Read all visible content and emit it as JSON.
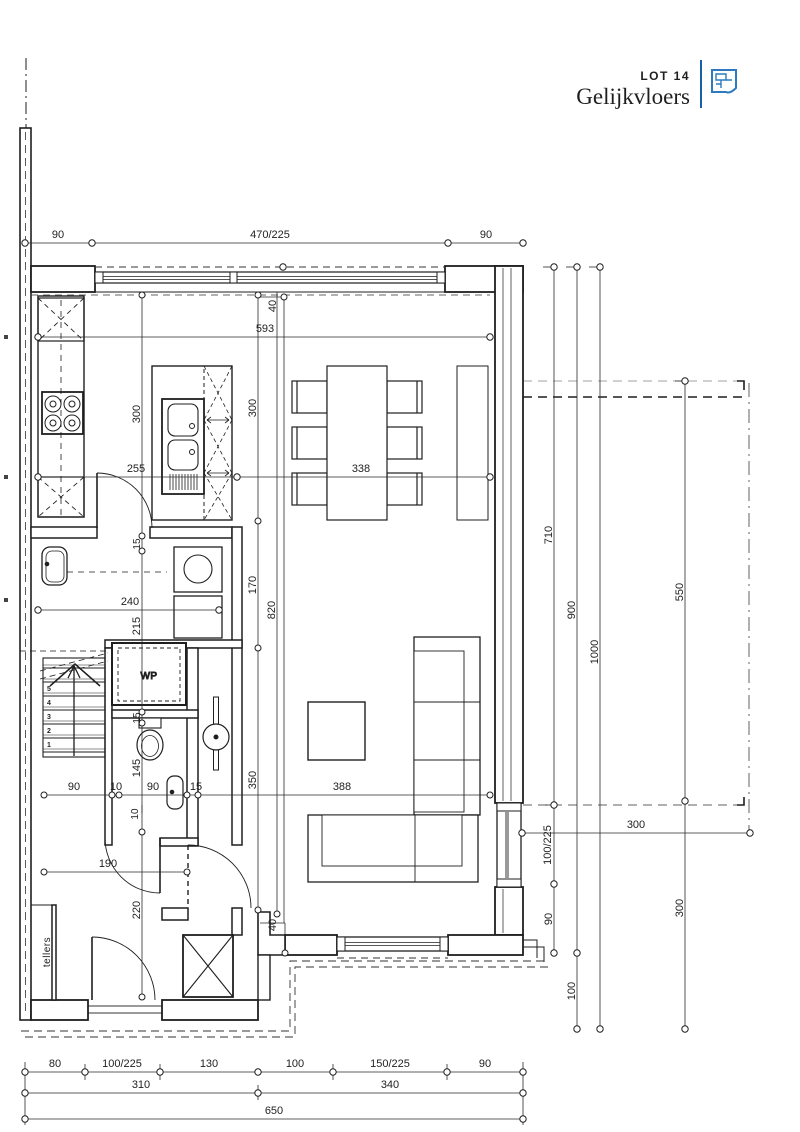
{
  "title_block": {
    "lot_label": "LOT 14",
    "floor_label": "Gelijkvloers",
    "accent_color": "#1b5fa8",
    "lot_color": "#4d8cc2",
    "icon": "floorplan-icon"
  },
  "rooms": {
    "wp_label": "WP",
    "tellers_label": "tellers"
  },
  "stairs": {
    "treads": [
      "1",
      "2",
      "3",
      "4",
      "5"
    ]
  },
  "dims": {
    "top": {
      "a": "90",
      "b": "470/225",
      "c": "90"
    },
    "plan": {
      "d593": "593",
      "d40_top": "40",
      "d300_left": "300",
      "d300_right": "300",
      "d255": "255",
      "d338": "338",
      "d15_a": "15",
      "d240": "240",
      "d215": "215",
      "d170": "170",
      "d820": "820",
      "d15_b": "15",
      "d145": "145",
      "d90_a": "90",
      "d10_a": "10",
      "d90_b": "90",
      "d15_c": "15",
      "d350": "350",
      "d388": "388",
      "d10_b": "10",
      "d190": "190",
      "d220": "220",
      "d40_bottom": "40"
    },
    "right": {
      "d710": "710",
      "d900": "900",
      "d1000": "1000",
      "d550": "550",
      "d100_225": "100/225",
      "d90": "90",
      "d100": "100",
      "d300_v": "300",
      "d300_h": "300"
    },
    "bottom": {
      "r1": [
        "80",
        "100/225",
        "130",
        "100",
        "150/225",
        "90"
      ],
      "r2": [
        "310",
        "340"
      ],
      "r3": [
        "650"
      ]
    }
  }
}
